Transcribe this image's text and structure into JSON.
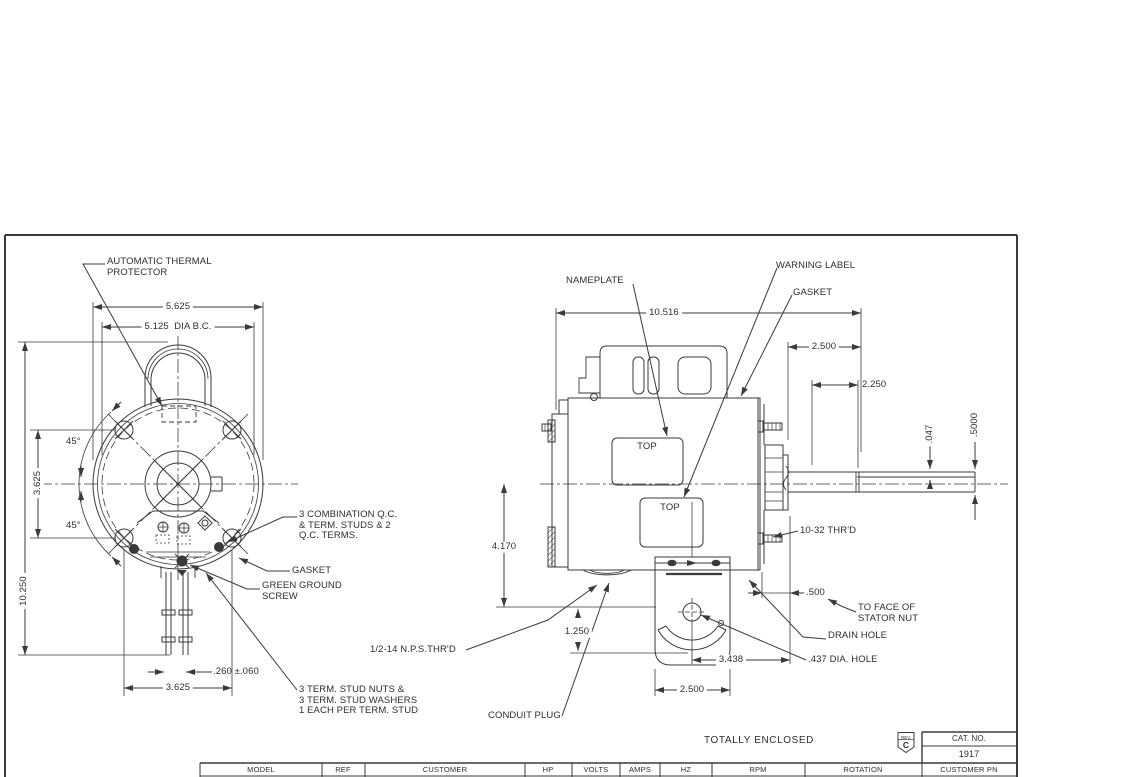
{
  "front_view": {
    "labels": {
      "thermal_protector": "AUTOMATIC THERMAL\nPROTECTOR",
      "qc_terms": "3 COMBINATION Q.C.\n& TERM. STUDS & 2\nQ.C. TERMS.",
      "gasket": "GASKET",
      "ground_screw": "GREEN GROUND\nSCREW",
      "stud_nuts": "3 TERM. STUD NUTS &\n3 TERM. STUD WASHERS\n1 EACH PER TERM. STUD"
    },
    "dims": {
      "width": "5.625",
      "bolt_circle": "5.125  DIA B.C.",
      "angle_top": "45°",
      "angle_bottom": "45°",
      "bolt_span_vertical": "3.625",
      "overall_height": "10.250",
      "stud_dia": ".260 ±.060",
      "bolt_span_horizontal": "3.625"
    }
  },
  "side_view": {
    "labels": {
      "nameplate": "NAMEPLATE",
      "warning_label": "WARNING LABEL",
      "gasket": "GASKET",
      "top_upper": "TOP",
      "top_lower": "TOP",
      "thread": "10-32 THR'D",
      "stator_face": "TO FACE OF\nSTATOR NUT",
      "drain_hole": "DRAIN HOLE",
      "dia_hole": ".437 DIA. HOLE",
      "nps_thread": "1/2-14 N.P.S.THR'D",
      "conduit_plug": "CONDUIT PLUG"
    },
    "dims": {
      "overall_length": "10.516",
      "cover_width": "2.500",
      "shaft_flat": "2.250",
      "flat_depth": ".047",
      "shaft_dia": ".5000",
      "center_height": "4.170",
      "base_offset": "1.250",
      "nut_face": ".500",
      "hole_offset": "3.438",
      "base_width": "2.500"
    }
  },
  "footer": {
    "enclosure": "TOTALLY ENCLOSED",
    "rev_label": "REV.",
    "rev": "C",
    "cat_no_label": "CAT. NO.",
    "cat_no": "1917",
    "columns": [
      "MODEL",
      "REF",
      "CUSTOMER",
      "HP",
      "VOLTS",
      "AMPS",
      "HZ",
      "RPM",
      "ROTATION",
      "CUSTOMER PN"
    ]
  }
}
